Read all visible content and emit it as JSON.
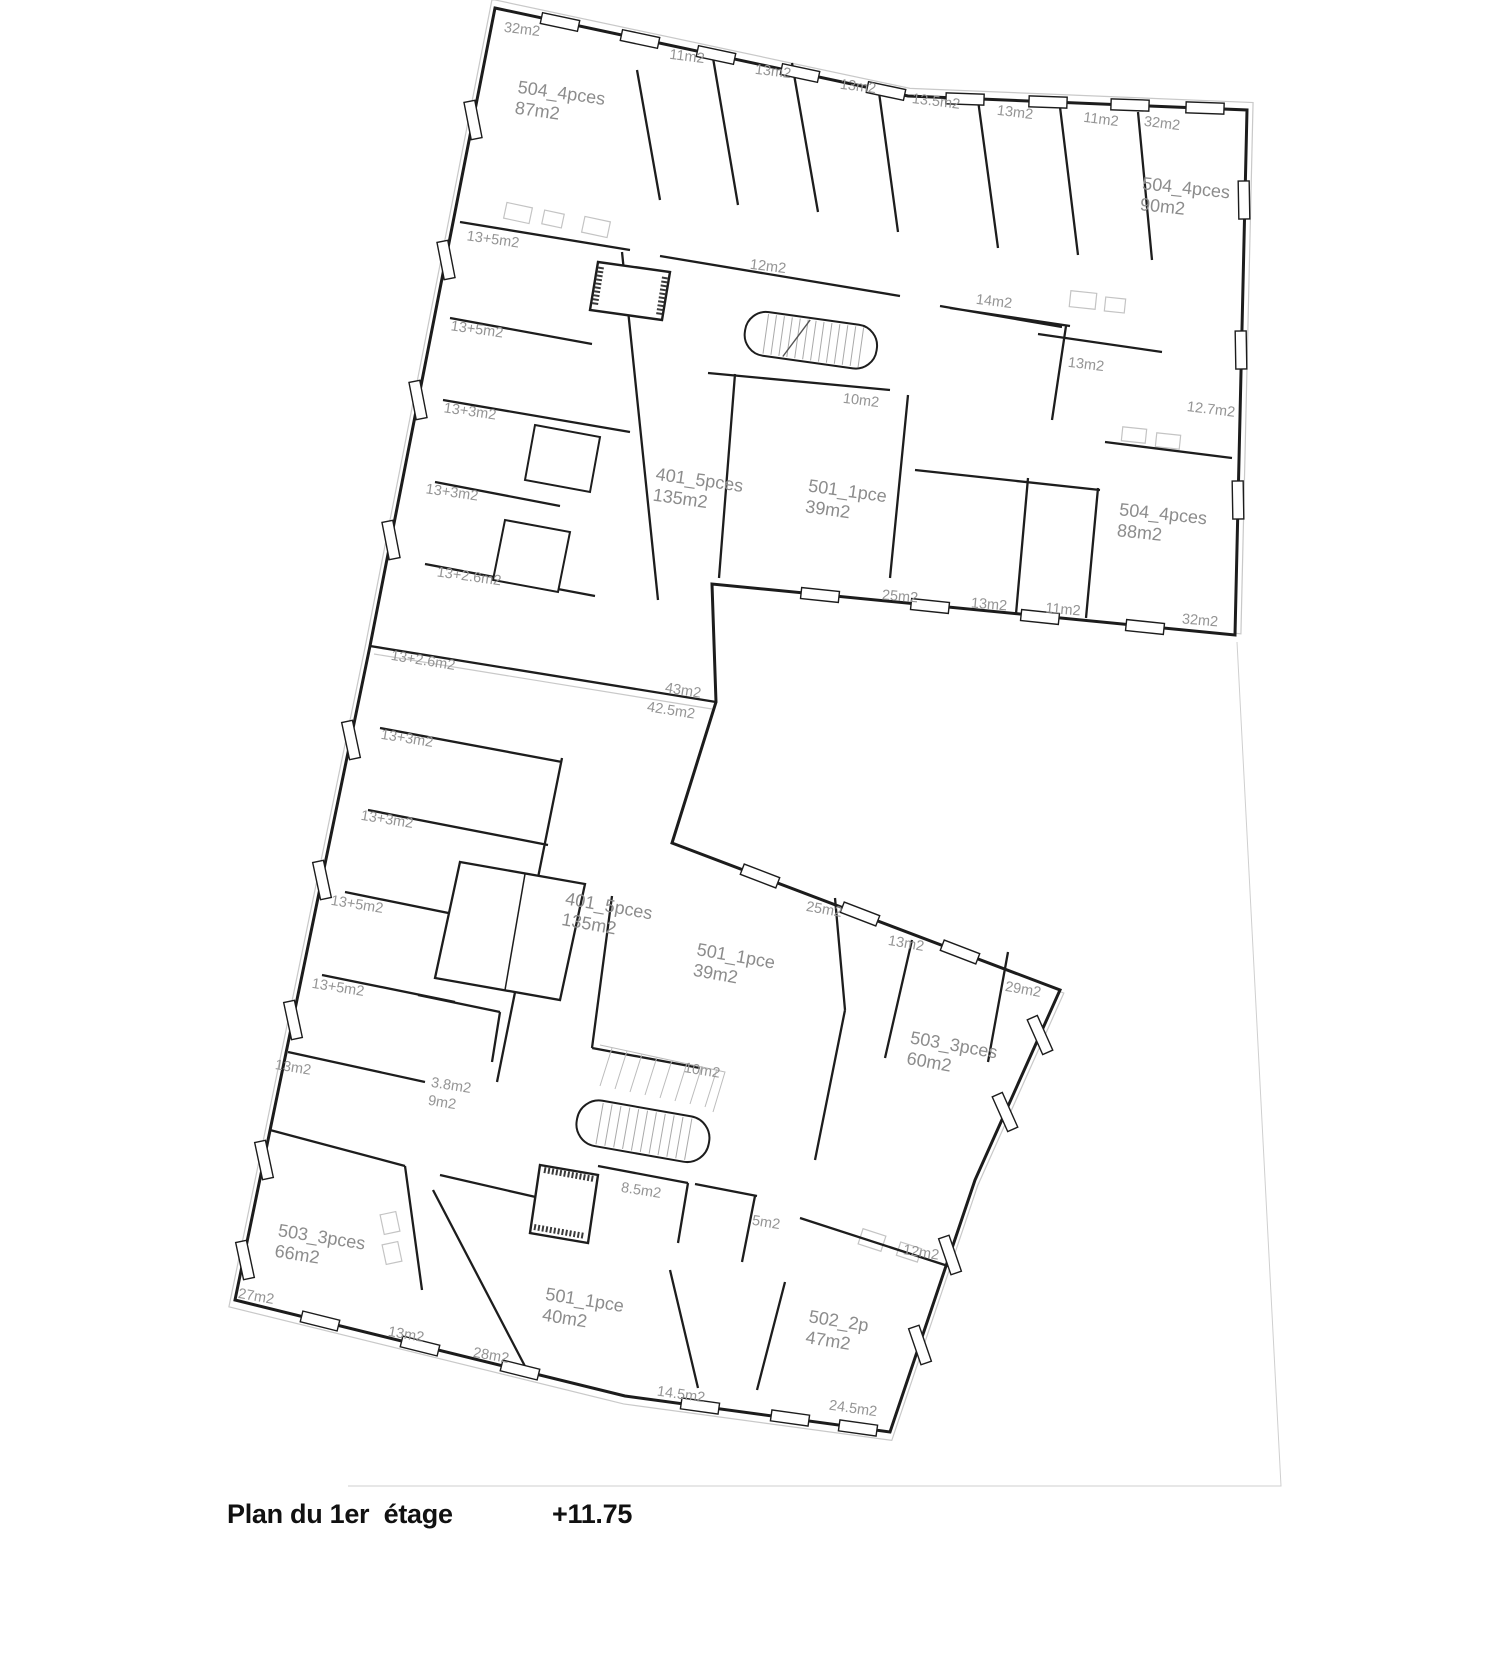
{
  "caption": {
    "title": "Plan du 1er  étage",
    "elevation": "+11.75"
  },
  "plan": {
    "ink_color": "#1c1c1c",
    "label_color": "#949494",
    "labels": [
      {
        "lines": [
          "32m2"
        ],
        "x": 522,
        "y": 30,
        "r": 7,
        "kind": "room"
      },
      {
        "lines": [
          "11m2"
        ],
        "x": 687,
        "y": 57,
        "r": 7,
        "kind": "room"
      },
      {
        "lines": [
          "13m2"
        ],
        "x": 773,
        "y": 72,
        "r": 7,
        "kind": "room"
      },
      {
        "lines": [
          "13m2"
        ],
        "x": 858,
        "y": 87,
        "r": 7,
        "kind": "room"
      },
      {
        "lines": [
          "13.5m2"
        ],
        "x": 936,
        "y": 102,
        "r": 7,
        "kind": "room"
      },
      {
        "lines": [
          "13m2"
        ],
        "x": 1015,
        "y": 113,
        "r": 7,
        "kind": "room"
      },
      {
        "lines": [
          "11m2"
        ],
        "x": 1101,
        "y": 120,
        "r": 7,
        "kind": "room"
      },
      {
        "lines": [
          "32m2"
        ],
        "x": 1162,
        "y": 124,
        "r": 7,
        "kind": "room"
      },
      {
        "lines": [
          "504_4pces",
          "87m2"
        ],
        "x": 560,
        "y": 104,
        "r": 8,
        "kind": "unit"
      },
      {
        "lines": [
          "504_4pces",
          "90m2"
        ],
        "x": 1185,
        "y": 199,
        "r": 6,
        "kind": "unit"
      },
      {
        "lines": [
          "13+5m2"
        ],
        "x": 493,
        "y": 240,
        "r": 8,
        "kind": "room"
      },
      {
        "lines": [
          "12m2"
        ],
        "x": 768,
        "y": 267,
        "r": 7,
        "kind": "room"
      },
      {
        "lines": [
          "14m2"
        ],
        "x": 994,
        "y": 302,
        "r": 7,
        "kind": "room"
      },
      {
        "lines": [
          "13+5m2"
        ],
        "x": 477,
        "y": 330,
        "r": 8,
        "kind": "room"
      },
      {
        "lines": [
          "13m2"
        ],
        "x": 1086,
        "y": 365,
        "r": 7,
        "kind": "room"
      },
      {
        "lines": [
          "10m2"
        ],
        "x": 861,
        "y": 401,
        "r": 7,
        "kind": "room"
      },
      {
        "lines": [
          "12.7m2"
        ],
        "x": 1211,
        "y": 410,
        "r": 7,
        "kind": "room"
      },
      {
        "lines": [
          "13+3m2"
        ],
        "x": 470,
        "y": 412,
        "r": 8,
        "kind": "room"
      },
      {
        "lines": [
          "401_5pces",
          "135m2"
        ],
        "x": 698,
        "y": 491,
        "r": 8,
        "kind": "unit"
      },
      {
        "lines": [
          "501_1pce",
          "39m2"
        ],
        "x": 846,
        "y": 502,
        "r": 8,
        "kind": "unit"
      },
      {
        "lines": [
          "504_4pces",
          "88m2"
        ],
        "x": 1162,
        "y": 525,
        "r": 6,
        "kind": "unit"
      },
      {
        "lines": [
          "13+3m2"
        ],
        "x": 452,
        "y": 493,
        "r": 8,
        "kind": "room"
      },
      {
        "lines": [
          "13+2.6m2"
        ],
        "x": 469,
        "y": 577,
        "r": 8,
        "kind": "room"
      },
      {
        "lines": [
          "25m2"
        ],
        "x": 900,
        "y": 597,
        "r": 5,
        "kind": "room"
      },
      {
        "lines": [
          "13m2"
        ],
        "x": 989,
        "y": 605,
        "r": 5,
        "kind": "room"
      },
      {
        "lines": [
          "11m2"
        ],
        "x": 1063,
        "y": 610,
        "r": 5,
        "kind": "room"
      },
      {
        "lines": [
          "32m2"
        ],
        "x": 1200,
        "y": 621,
        "r": 5,
        "kind": "room"
      },
      {
        "lines": [
          "13+2.6m2"
        ],
        "x": 423,
        "y": 661,
        "r": 9,
        "kind": "room"
      },
      {
        "lines": [
          "43m2"
        ],
        "x": 683,
        "y": 691,
        "r": 9,
        "kind": "room"
      },
      {
        "lines": [
          "42.5m2"
        ],
        "x": 671,
        "y": 711,
        "r": 9,
        "kind": "room"
      },
      {
        "lines": [
          "13+3m2"
        ],
        "x": 407,
        "y": 739,
        "r": 9,
        "kind": "room"
      },
      {
        "lines": [
          "13+3m2"
        ],
        "x": 387,
        "y": 820,
        "r": 9,
        "kind": "room"
      },
      {
        "lines": [
          "13+5m2"
        ],
        "x": 357,
        "y": 905,
        "r": 9,
        "kind": "room"
      },
      {
        "lines": [
          "401_5pces",
          "135m2"
        ],
        "x": 607,
        "y": 917,
        "r": 10,
        "kind": "unit"
      },
      {
        "lines": [
          "25m2"
        ],
        "x": 824,
        "y": 910,
        "r": 10,
        "kind": "room"
      },
      {
        "lines": [
          "13m2"
        ],
        "x": 906,
        "y": 944,
        "r": 10,
        "kind": "room"
      },
      {
        "lines": [
          "501_1pce",
          "39m2"
        ],
        "x": 734,
        "y": 967,
        "r": 10,
        "kind": "unit"
      },
      {
        "lines": [
          "13+5m2"
        ],
        "x": 338,
        "y": 988,
        "r": 9,
        "kind": "room"
      },
      {
        "lines": [
          "29m2"
        ],
        "x": 1023,
        "y": 990,
        "r": 10,
        "kind": "room"
      },
      {
        "lines": [
          "503_3pces",
          "60m2"
        ],
        "x": 952,
        "y": 1056,
        "r": 10,
        "kind": "unit"
      },
      {
        "lines": [
          "13m2"
        ],
        "x": 293,
        "y": 1068,
        "r": 9,
        "kind": "room"
      },
      {
        "lines": [
          "10m2"
        ],
        "x": 702,
        "y": 1071,
        "r": 9,
        "kind": "room"
      },
      {
        "lines": [
          "3.8m2"
        ],
        "x": 451,
        "y": 1086,
        "r": 9,
        "kind": "room"
      },
      {
        "lines": [
          "9m2"
        ],
        "x": 442,
        "y": 1103,
        "r": 9,
        "kind": "room"
      },
      {
        "lines": [
          "8.5m2"
        ],
        "x": 641,
        "y": 1191,
        "r": 9,
        "kind": "room"
      },
      {
        "lines": [
          "5m2"
        ],
        "x": 766,
        "y": 1223,
        "r": 9,
        "kind": "room"
      },
      {
        "lines": [
          "12m2"
        ],
        "x": 921,
        "y": 1253,
        "r": 9,
        "kind": "room"
      },
      {
        "lines": [
          "503_3pces",
          "66m2"
        ],
        "x": 320,
        "y": 1248,
        "r": 9,
        "kind": "unit"
      },
      {
        "lines": [
          "27m2"
        ],
        "x": 256,
        "y": 1297,
        "r": 10,
        "kind": "room"
      },
      {
        "lines": [
          "501_1pce",
          "40m2"
        ],
        "x": 583,
        "y": 1311,
        "r": 9,
        "kind": "unit"
      },
      {
        "lines": [
          "502_2p",
          "47m2"
        ],
        "x": 837,
        "y": 1332,
        "r": 9,
        "kind": "unit"
      },
      {
        "lines": [
          "13m2"
        ],
        "x": 406,
        "y": 1335,
        "r": 10,
        "kind": "room"
      },
      {
        "lines": [
          "28m2"
        ],
        "x": 491,
        "y": 1356,
        "r": 10,
        "kind": "room"
      },
      {
        "lines": [
          "14.5m2"
        ],
        "x": 681,
        "y": 1395,
        "r": 8,
        "kind": "room"
      },
      {
        "lines": [
          "24.5m2"
        ],
        "x": 853,
        "y": 1409,
        "r": 8,
        "kind": "room"
      }
    ]
  }
}
